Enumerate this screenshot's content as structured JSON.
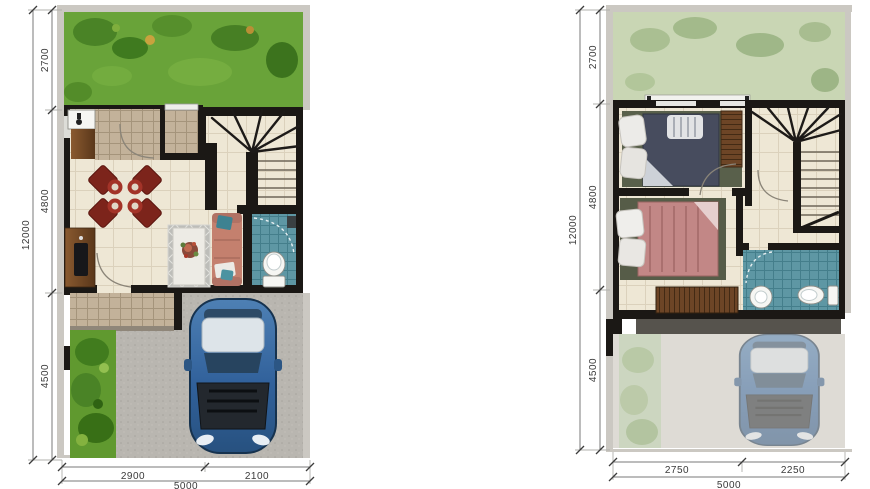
{
  "diagram": {
    "type": "architectural-floor-plans",
    "left_plan": {
      "overall_depth": "12000",
      "depth_segments": [
        "2700",
        "4800",
        "4500"
      ],
      "width_segments": [
        "2900",
        "2100"
      ],
      "overall_width": "5000"
    },
    "right_plan": {
      "overall_depth": "12000",
      "depth_segments": [
        "2700",
        "4800",
        "4500"
      ],
      "width_segments": [
        "2750",
        "2250"
      ],
      "overall_width": "5000"
    },
    "colors": {
      "wall": "#1b1815",
      "plot_wall": "#cbc8c2",
      "grass": "#69a339",
      "grass_faded": "#c9d6b4",
      "driveway": "#b9b6b0",
      "sofa": "#c4806e",
      "floor_tile": "#eee7d5",
      "beige_tile": "#c3b29a",
      "teal_tile": "#5e97a4",
      "wood": "#6d4526",
      "car_blue": "#31619b",
      "dim_text": "#3a3a3a"
    }
  }
}
